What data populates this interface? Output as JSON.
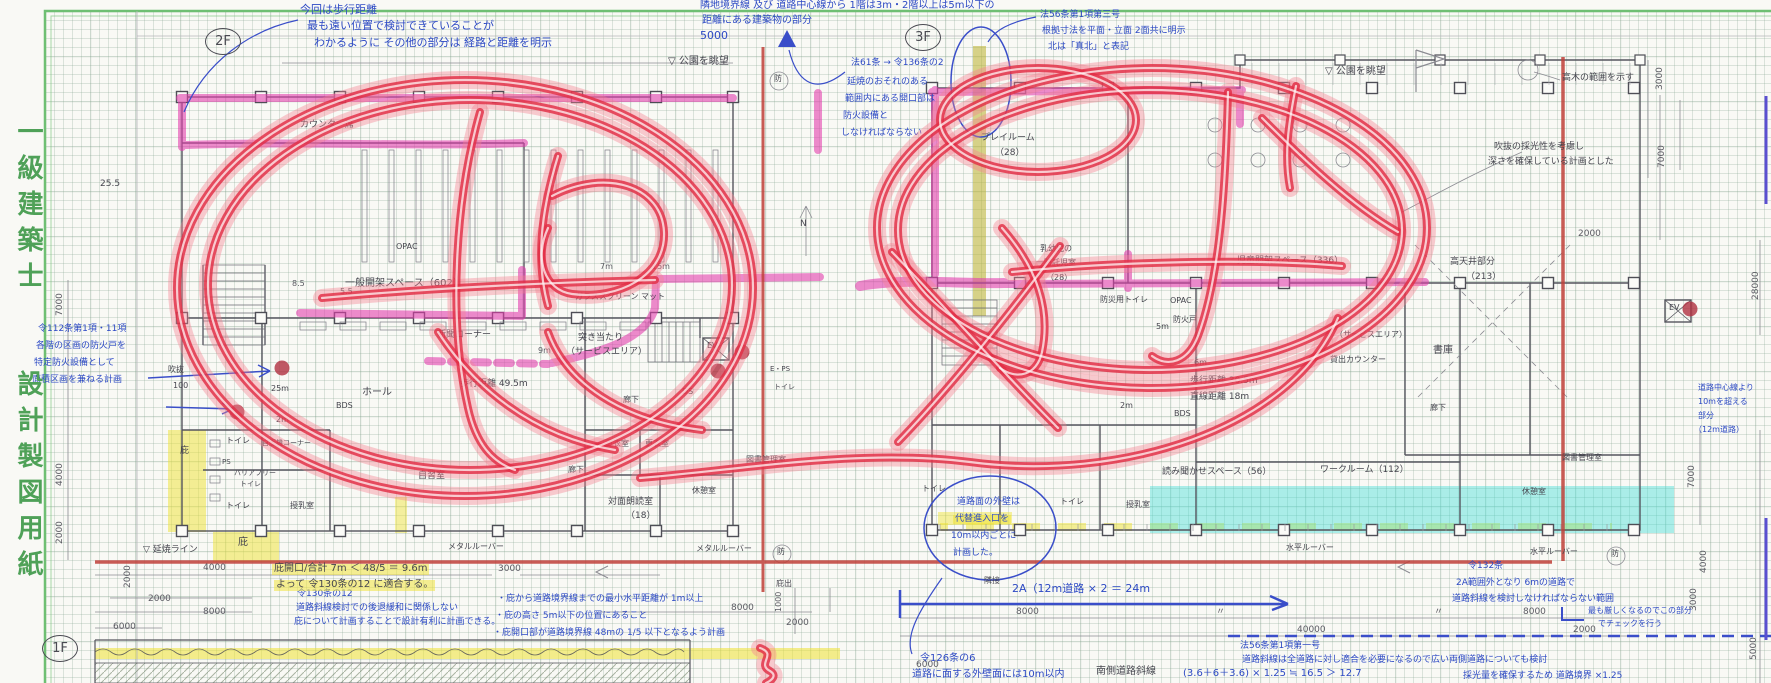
{
  "page": {
    "title_vertical": "一級建築士　　設計製図用紙"
  },
  "palette": {
    "frame_green": "#6fbf73",
    "ink_blue": "#2c49c4",
    "pencil_ink": "#45454e",
    "marker_red": "#e22e46",
    "wall_highlight_pink": "#e23fae",
    "highlight_yellow": "#eee232",
    "highlight_cyan": "#3edcd6",
    "delineation_red": "#c04038"
  },
  "floor_plans": [
    {
      "label": "2F"
    },
    {
      "label": "3F"
    },
    {
      "label": "1F"
    }
  ],
  "annotations": [
    {
      "t": "今回は歩行距離",
      "x": 300,
      "y": 4,
      "c": "b",
      "s": 11
    },
    {
      "t": "最も遠い位置で検討できていることが",
      "x": 307,
      "y": 20,
      "c": "b",
      "s": 11
    },
    {
      "t": "わかるように その他の部分は 経路と距離を明示",
      "x": 314,
      "y": 37,
      "c": "b",
      "s": 11
    },
    {
      "t": "隣地境界線 及び 道路中心線から 1階は3m・2階以上は5m以下の",
      "x": 700,
      "y": 1,
      "c": "b",
      "s": 10
    },
    {
      "t": "距離にある建築物の部分",
      "x": 702,
      "y": 16,
      "c": "b",
      "s": 10
    },
    {
      "t": "5000",
      "x": 700,
      "y": 30,
      "c": "b",
      "s": 11
    },
    {
      "t": "法61条 → 令136条の2",
      "x": 851,
      "y": 59,
      "c": "b",
      "s": 9
    },
    {
      "t": "延焼のおそれのある",
      "x": 847,
      "y": 78,
      "c": "b",
      "s": 9
    },
    {
      "t": "範囲内にある開口部は",
      "x": 845,
      "y": 95,
      "c": "b",
      "s": 9
    },
    {
      "t": "防火設備と",
      "x": 843,
      "y": 112,
      "c": "b",
      "s": 9
    },
    {
      "t": "しなければならない",
      "x": 841,
      "y": 129,
      "c": "b",
      "s": 9
    },
    {
      "t": "法56条第1項第三号",
      "x": 1040,
      "y": 11,
      "c": "b",
      "s": 9
    },
    {
      "t": "根拠寸法を平面・立面 2面共に明示",
      "x": 1042,
      "y": 27,
      "c": "b",
      "s": 9
    },
    {
      "t": "北は「真北」と表記",
      "x": 1048,
      "y": 43,
      "c": "b",
      "s": 9
    },
    {
      "t": "令112条第1項・11項",
      "x": 38,
      "y": 325,
      "c": "b",
      "s": 9
    },
    {
      "t": "各階の区画の防火戸を",
      "x": 36,
      "y": 342,
      "c": "b",
      "s": 9
    },
    {
      "t": "特定防火設備として",
      "x": 34,
      "y": 359,
      "c": "b",
      "s": 9
    },
    {
      "t": "面積区画を兼ねる計画",
      "x": 32,
      "y": 376,
      "c": "b",
      "s": 9
    },
    {
      "t": "道路面の外壁は",
      "x": 957,
      "y": 498,
      "c": "b",
      "s": 9
    },
    {
      "t": "代替進入口を",
      "x": 953,
      "y": 515,
      "c": "b",
      "s": 9,
      "h": 1
    },
    {
      "t": "10m以内ごとに",
      "x": 951,
      "y": 532,
      "c": "b",
      "s": 9
    },
    {
      "t": "計画した。",
      "x": 953,
      "y": 549,
      "c": "b",
      "s": 9
    },
    {
      "t": "2A（12m道路 × 2 ＝ 24m",
      "x": 1012,
      "y": 583,
      "c": "b",
      "s": 11
    },
    {
      "t": "道路中心線より",
      "x": 1698,
      "y": 384,
      "c": "b",
      "s": 8
    },
    {
      "t": "10mを超える",
      "x": 1698,
      "y": 398,
      "c": "b",
      "s": 8
    },
    {
      "t": "部分",
      "x": 1698,
      "y": 412,
      "c": "b",
      "s": 8
    },
    {
      "t": "（12m道路）",
      "x": 1694,
      "y": 426,
      "c": "b",
      "s": 8
    },
    {
      "t": "令132条",
      "x": 1468,
      "y": 562,
      "c": "b",
      "s": 9
    },
    {
      "t": "2A範囲外となり 6mの道路で",
      "x": 1456,
      "y": 579,
      "c": "b",
      "s": 9
    },
    {
      "t": "道路斜線を検討しなければならない範囲",
      "x": 1452,
      "y": 595,
      "c": "b",
      "s": 9
    },
    {
      "t": "最も厳しくなるのでこの部分",
      "x": 1588,
      "y": 607,
      "c": "b",
      "s": 8
    },
    {
      "t": "でチェックを行う",
      "x": 1598,
      "y": 620,
      "c": "b",
      "s": 8
    },
    {
      "t": "令130条の12",
      "x": 297,
      "y": 590,
      "c": "b",
      "s": 9
    },
    {
      "t": "道路斜線検討での後退緩和に関係しない",
      "x": 296,
      "y": 604,
      "c": "b",
      "s": 9
    },
    {
      "t": "庇について計画することで設計有利に計画できる。",
      "x": 294,
      "y": 618,
      "c": "b",
      "s": 9
    },
    {
      "t": "・庇から道路境界線までの最小水平距離が 1m以上",
      "x": 497,
      "y": 595,
      "c": "b",
      "s": 9
    },
    {
      "t": "・庇の高さ 5m以下の位置にあること",
      "x": 495,
      "y": 612,
      "c": "b",
      "s": 9
    },
    {
      "t": "・庇開口部が道路境界線 48mの 1/5 以下となるよう計画",
      "x": 493,
      "y": 629,
      "c": "b",
      "s": 9
    },
    {
      "t": "令126条の6",
      "x": 920,
      "y": 654,
      "c": "b",
      "s": 10
    },
    {
      "t": "道路に面する外壁面には10m以内",
      "x": 912,
      "y": 670,
      "c": "b",
      "s": 10
    },
    {
      "t": "法56条第1項第一号",
      "x": 1240,
      "y": 642,
      "c": "b",
      "s": 9
    },
    {
      "t": "道路斜線は全道路に対し適合を必要になるので広い両側道路についても検討",
      "x": 1242,
      "y": 656,
      "c": "b",
      "s": 9
    },
    {
      "t": "(3.6＋6＋3.6) × 1.25 ≒ 16.5 ＞ 12.7",
      "x": 1183,
      "y": 669,
      "c": "b",
      "s": 10
    },
    {
      "t": "採光量を確保するため 道路境界 ×1.25",
      "x": 1463,
      "y": 672,
      "c": "b",
      "s": 9
    },
    {
      "t": "▽ 公園を眺望",
      "x": 668,
      "y": 57,
      "c": "k",
      "s": 10
    },
    {
      "t": "▽ 公園を眺望",
      "x": 1325,
      "y": 67,
      "c": "k",
      "s": 10
    },
    {
      "t": "カウンター席",
      "x": 300,
      "y": 121,
      "c": "k",
      "s": 9
    },
    {
      "t": "25.5",
      "x": 100,
      "y": 180,
      "c": "k",
      "s": 9
    },
    {
      "t": "一般開架スペース（602）",
      "x": 345,
      "y": 279,
      "c": "k",
      "s": 10
    },
    {
      "t": "OPAC",
      "x": 396,
      "y": 243,
      "c": "k",
      "s": 8
    },
    {
      "t": "OPAC",
      "x": 1170,
      "y": 297,
      "c": "k",
      "s": 8
    },
    {
      "t": "新聞コーナー",
      "x": 437,
      "y": 331,
      "c": "k",
      "s": 9
    },
    {
      "t": "ホール",
      "x": 362,
      "y": 388,
      "c": "k",
      "s": 10
    },
    {
      "t": "BDS",
      "x": 336,
      "y": 402,
      "c": "k",
      "s": 8
    },
    {
      "t": "歩行距離 49.5m",
      "x": 460,
      "y": 380,
      "c": "k",
      "s": 9
    },
    {
      "t": "ガラススクリーン マット",
      "x": 575,
      "y": 293,
      "c": "k",
      "s": 8
    },
    {
      "t": "突き当たり",
      "x": 578,
      "y": 334,
      "c": "k",
      "s": 9
    },
    {
      "t": "（サービスエリア）",
      "x": 566,
      "y": 348,
      "c": "k",
      "s": 9
    },
    {
      "t": "吹抜",
      "x": 168,
      "y": 366,
      "c": "k",
      "s": 8
    },
    {
      "t": "100",
      "x": 173,
      "y": 382,
      "c": "k",
      "s": 8
    },
    {
      "t": "25m",
      "x": 271,
      "y": 385,
      "c": "k",
      "s": 8
    },
    {
      "t": "2m",
      "x": 276,
      "y": 416,
      "c": "k",
      "s": 8
    },
    {
      "t": "トイレ",
      "x": 226,
      "y": 437,
      "c": "k",
      "s": 8
    },
    {
      "t": "PS",
      "x": 222,
      "y": 459,
      "c": "k",
      "s": 7
    },
    {
      "t": "バリアフリー",
      "x": 234,
      "y": 470,
      "c": "k",
      "s": 7
    },
    {
      "t": "トイレ",
      "x": 240,
      "y": 481,
      "c": "k",
      "s": 7
    },
    {
      "t": "トイレ",
      "x": 226,
      "y": 502,
      "c": "k",
      "s": 8
    },
    {
      "t": "自販機コーナー",
      "x": 262,
      "y": 440,
      "c": "k",
      "s": 7
    },
    {
      "t": "授乳室",
      "x": 290,
      "y": 502,
      "c": "k",
      "s": 8
    },
    {
      "t": "庇",
      "x": 180,
      "y": 447,
      "c": "k",
      "s": 9
    },
    {
      "t": "庇",
      "x": 238,
      "y": 538,
      "c": "k",
      "s": 10
    },
    {
      "t": "▽ 延焼ライン",
      "x": 143,
      "y": 546,
      "c": "k",
      "s": 9
    },
    {
      "t": "自習室",
      "x": 418,
      "y": 472,
      "c": "k",
      "s": 9
    },
    {
      "t": "更衣室",
      "x": 605,
      "y": 440,
      "c": "k",
      "s": 8
    },
    {
      "t": "更衣室",
      "x": 645,
      "y": 440,
      "c": "k",
      "s": 8
    },
    {
      "t": "廊下",
      "x": 623,
      "y": 396,
      "c": "k",
      "s": 8
    },
    {
      "t": "廊下",
      "x": 568,
      "y": 466,
      "c": "k",
      "s": 8
    },
    {
      "t": "EV",
      "x": 707,
      "y": 342,
      "c": "k",
      "s": 8
    },
    {
      "t": "DS",
      "x": 682,
      "y": 388,
      "c": "k",
      "s": 8
    },
    {
      "t": "E・PS",
      "x": 770,
      "y": 366,
      "c": "k",
      "s": 7
    },
    {
      "t": "トイレ",
      "x": 774,
      "y": 384,
      "c": "k",
      "s": 7
    },
    {
      "t": "図書管理室",
      "x": 746,
      "y": 456,
      "c": "k",
      "s": 8
    },
    {
      "t": "対面朗読室",
      "x": 608,
      "y": 498,
      "c": "k",
      "s": 9
    },
    {
      "t": "（18）",
      "x": 626,
      "y": 512,
      "c": "k",
      "s": 9
    },
    {
      "t": "休憩室",
      "x": 692,
      "y": 487,
      "c": "k",
      "s": 8
    },
    {
      "t": "メタルルーバー",
      "x": 448,
      "y": 543,
      "c": "k",
      "s": 8
    },
    {
      "t": "メタルルーバー",
      "x": 696,
      "y": 545,
      "c": "k",
      "s": 8
    },
    {
      "t": "水平ルーバー",
      "x": 1286,
      "y": 544,
      "c": "k",
      "s": 8
    },
    {
      "t": "水平ルーバー",
      "x": 1530,
      "y": 548,
      "c": "k",
      "s": 8
    },
    {
      "t": "プレイルーム",
      "x": 981,
      "y": 134,
      "c": "k",
      "s": 9
    },
    {
      "t": "（28）",
      "x": 995,
      "y": 149,
      "c": "k",
      "s": 9
    },
    {
      "t": "乳幼児の",
      "x": 1040,
      "y": 245,
      "c": "k",
      "s": 8
    },
    {
      "t": "一時託児室",
      "x": 1036,
      "y": 259,
      "c": "k",
      "s": 8
    },
    {
      "t": "（28）",
      "x": 1046,
      "y": 274,
      "c": "k",
      "s": 8
    },
    {
      "t": "防災用トイレ",
      "x": 1100,
      "y": 296,
      "c": "k",
      "s": 8
    },
    {
      "t": "防火戸",
      "x": 1173,
      "y": 316,
      "c": "k",
      "s": 8
    },
    {
      "t": "児童開架スペース（336）",
      "x": 1237,
      "y": 257,
      "c": "k",
      "s": 9
    },
    {
      "t": "（サービスエリア）",
      "x": 1335,
      "y": 331,
      "c": "k",
      "s": 8
    },
    {
      "t": "貸出カウンター",
      "x": 1330,
      "y": 356,
      "c": "k",
      "s": 8
    },
    {
      "t": "書庫",
      "x": 1433,
      "y": 346,
      "c": "k",
      "s": 10
    },
    {
      "t": "歩行距離 30.5m",
      "x": 1190,
      "y": 377,
      "c": "k",
      "s": 9
    },
    {
      "t": "直線距離 18m",
      "x": 1190,
      "y": 393,
      "c": "k",
      "s": 9
    },
    {
      "t": "BDS",
      "x": 1174,
      "y": 410,
      "c": "k",
      "s": 8
    },
    {
      "t": "6m",
      "x": 1194,
      "y": 359,
      "c": "k",
      "s": 8
    },
    {
      "t": "5m",
      "x": 1156,
      "y": 323,
      "c": "k",
      "s": 8
    },
    {
      "t": "2m",
      "x": 1120,
      "y": 402,
      "c": "k",
      "s": 8
    },
    {
      "t": "高天井部分",
      "x": 1450,
      "y": 258,
      "c": "k",
      "s": 9
    },
    {
      "t": "（213）",
      "x": 1466,
      "y": 273,
      "c": "k",
      "s": 9
    },
    {
      "t": "高木の範囲を示す",
      "x": 1562,
      "y": 74,
      "c": "k",
      "s": 9
    },
    {
      "t": "吹抜の採光性を考慮し",
      "x": 1494,
      "y": 143,
      "c": "k",
      "s": 9
    },
    {
      "t": "深さを確保している計画とした",
      "x": 1488,
      "y": 158,
      "c": "k",
      "s": 9
    },
    {
      "t": "読み聞かせスペース（56）",
      "x": 1162,
      "y": 468,
      "c": "k",
      "s": 9
    },
    {
      "t": "ワークルーム（112）",
      "x": 1320,
      "y": 466,
      "c": "k",
      "s": 9
    },
    {
      "t": "図書管理室",
      "x": 1562,
      "y": 454,
      "c": "k",
      "s": 8
    },
    {
      "t": "休憩室",
      "x": 1522,
      "y": 488,
      "c": "k",
      "s": 8
    },
    {
      "t": "廊下",
      "x": 1430,
      "y": 404,
      "c": "k",
      "s": 8
    },
    {
      "t": "トイレ",
      "x": 922,
      "y": 485,
      "c": "k",
      "s": 8
    },
    {
      "t": "トイレ",
      "x": 1060,
      "y": 498,
      "c": "k",
      "s": 8
    },
    {
      "t": "授乳室",
      "x": 1126,
      "y": 501,
      "c": "k",
      "s": 8
    },
    {
      "t": "南側道路斜線",
      "x": 1096,
      "y": 667,
      "c": "k",
      "s": 10
    },
    {
      "t": "庇開口/合計 7m ＜ 48/5 ＝ 9.6m",
      "x": 272,
      "y": 564,
      "c": "k",
      "s": 10,
      "h": 1
    },
    {
      "t": "よって 令130条の12 に適合する。",
      "x": 274,
      "y": 580,
      "c": "k",
      "s": 10,
      "h": 1
    },
    {
      "t": "庇出",
      "x": 776,
      "y": 580,
      "c": "k",
      "s": 8
    },
    {
      "t": "隣接",
      "x": 984,
      "y": 577,
      "c": "k",
      "s": 8
    },
    {
      "t": "N",
      "x": 800,
      "y": 220,
      "c": "k",
      "s": 9
    },
    {
      "t": "防",
      "x": 774,
      "y": 75,
      "c": "k",
      "s": 8
    },
    {
      "t": "防",
      "x": 777,
      "y": 548,
      "c": "k",
      "s": 8
    },
    {
      "t": "防",
      "x": 1611,
      "y": 550,
      "c": "k",
      "s": 8
    },
    {
      "t": "EV",
      "x": 1669,
      "y": 304,
      "c": "k",
      "s": 8
    },
    {
      "t": "7000",
      "x": 56,
      "y": 316,
      "c": "d",
      "s": 9,
      "r": 1
    },
    {
      "t": "4000",
      "x": 56,
      "y": 486,
      "c": "d",
      "s": 9,
      "r": 1
    },
    {
      "t": "2000",
      "x": 56,
      "y": 544,
      "c": "d",
      "s": 9,
      "r": 1
    },
    {
      "t": "2000",
      "x": 124,
      "y": 588,
      "c": "d",
      "s": 9,
      "r": 1
    },
    {
      "t": "4000",
      "x": 203,
      "y": 564,
      "c": "d",
      "s": 9
    },
    {
      "t": "2000",
      "x": 148,
      "y": 595,
      "c": "d",
      "s": 9
    },
    {
      "t": "8000",
      "x": 203,
      "y": 608,
      "c": "d",
      "s": 9
    },
    {
      "t": "6000",
      "x": 113,
      "y": 623,
      "c": "d",
      "s": 9
    },
    {
      "t": "3000",
      "x": 498,
      "y": 565,
      "c": "d",
      "s": 9
    },
    {
      "t": "8000",
      "x": 731,
      "y": 604,
      "c": "d",
      "s": 9
    },
    {
      "t": "1000",
      "x": 775,
      "y": 612,
      "c": "d",
      "s": 8,
      "r": 1
    },
    {
      "t": "2000",
      "x": 786,
      "y": 619,
      "c": "d",
      "s": 9
    },
    {
      "t": "6000",
      "x": 916,
      "y": 661,
      "c": "d",
      "s": 9
    },
    {
      "t": "8000",
      "x": 1016,
      "y": 608,
      "c": "d",
      "s": 9
    },
    {
      "t": "〃",
      "x": 1216,
      "y": 608,
      "c": "d",
      "s": 9
    },
    {
      "t": "〃",
      "x": 1434,
      "y": 608,
      "c": "d",
      "s": 9
    },
    {
      "t": "8000",
      "x": 1523,
      "y": 608,
      "c": "d",
      "s": 9
    },
    {
      "t": "2000",
      "x": 1573,
      "y": 626,
      "c": "d",
      "s": 9
    },
    {
      "t": "40000",
      "x": 1297,
      "y": 626,
      "c": "d",
      "s": 9
    },
    {
      "t": "2000",
      "x": 1578,
      "y": 230,
      "c": "d",
      "s": 9
    },
    {
      "t": "3000",
      "x": 1656,
      "y": 90,
      "c": "d",
      "s": 9,
      "r": 1
    },
    {
      "t": "7000",
      "x": 1658,
      "y": 168,
      "c": "d",
      "s": 9,
      "r": 1
    },
    {
      "t": "28000",
      "x": 1752,
      "y": 300,
      "c": "d",
      "s": 9,
      "r": 1
    },
    {
      "t": "7000",
      "x": 1688,
      "y": 488,
      "c": "d",
      "s": 9,
      "r": 1
    },
    {
      "t": "4000",
      "x": 1700,
      "y": 573,
      "c": "d",
      "s": 9,
      "r": 1
    },
    {
      "t": "3000",
      "x": 1690,
      "y": 611,
      "c": "d",
      "s": 9,
      "r": 1
    },
    {
      "t": "5000",
      "x": 1750,
      "y": 660,
      "c": "d",
      "s": 9,
      "r": 1
    },
    {
      "t": "8.5",
      "x": 292,
      "y": 280,
      "c": "d",
      "s": 8
    },
    {
      "t": "5.5",
      "x": 340,
      "y": 288,
      "c": "d",
      "s": 8
    },
    {
      "t": "7m",
      "x": 600,
      "y": 263,
      "c": "d",
      "s": 8
    },
    {
      "t": "15m",
      "x": 652,
      "y": 263,
      "c": "d",
      "s": 8
    },
    {
      "t": "9m",
      "x": 538,
      "y": 347,
      "c": "d",
      "s": 8
    }
  ]
}
